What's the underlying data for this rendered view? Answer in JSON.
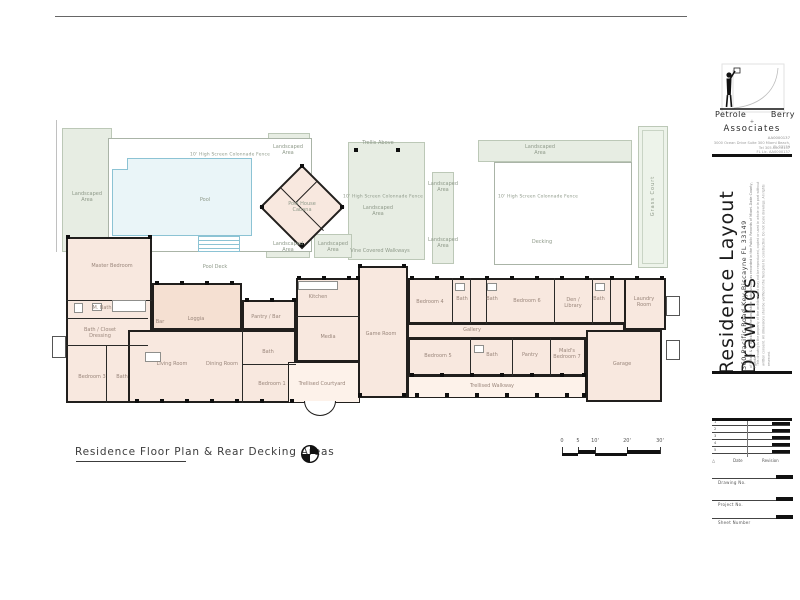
{
  "sheet": {
    "plan_title": "Residence Floor Plan & Rear Decking Areas",
    "scale_ticks": [
      "0",
      "5",
      "10'",
      "20'",
      "30'"
    ]
  },
  "plan": {
    "rooms": [
      "Master Bedroom",
      "M. Bath",
      "Bath / Closet Dressing",
      "Bedroom 3",
      "Bath",
      "Bar",
      "Loggia",
      "Pantry / Bar",
      "Living Room",
      "Dining Room",
      "Bath",
      "Bedroom 1",
      "Kitchen",
      "Media",
      "Game Room",
      "Trellised Courtyard",
      "Bedroom 4",
      "Bath",
      "Bath",
      "Bedroom 6",
      "Den / Library",
      "Bath",
      "Laundry Room",
      "Gallery",
      "Bedroom 5",
      "Bath",
      "Pantry",
      "Maid's Bedroom 7",
      "Garage",
      "Trellised Walkway"
    ],
    "site_labels": [
      "10' High Screen Colonnade Fence",
      "Trellis Above",
      "Landscaped Area",
      "Landscaped Area",
      "10' High Screen Colonnade Fence",
      "Landscaped Area",
      "Landscaped Area",
      "Landscaped Area",
      "10' High Screen Colonnade Fence",
      "Decking",
      "Vine Covered Walkways",
      "Landscaped Area",
      "Pool",
      "Pool Deck",
      "Pool House Cabana",
      "Grass Court",
      "Landscaped Area",
      "Landscaped Area"
    ]
  },
  "title_block": {
    "firm_first": "Petrole",
    "firm_last": "Berry",
    "firm_plus": "+",
    "firm_suffix": "Associates",
    "license": "AA0000137",
    "firm_address": [
      "3000 Ocean Drive  Suite 300  Miami Beach, FL 33139",
      "Tel 305.000.0137",
      "FL Lic. AA0000137"
    ],
    "project_title": "Residence Layout Drawings",
    "project_address": "360 Pacific Road   Key Biscayne   FL   33149",
    "legal_note": "of Lots 3 & 4, Block 3, Matheson Estate Subdivision, as recorded in the Public Records of Miami-Dade County, Florida",
    "disclaimer": "This drawing is the property of the architect and may not be reproduced, copied or used in whole or in part without written consent. All dimensions shall be verified in the field prior to construction. Do not scale drawings. All rights reserved.",
    "revision": {
      "rows": [
        "1",
        "2",
        "3",
        "4",
        "5"
      ],
      "delta": "△",
      "date_label": "Date",
      "revision_label": "Revision"
    },
    "fields": [
      "Drawing No.",
      "Project No.",
      "Sheet Number"
    ]
  }
}
